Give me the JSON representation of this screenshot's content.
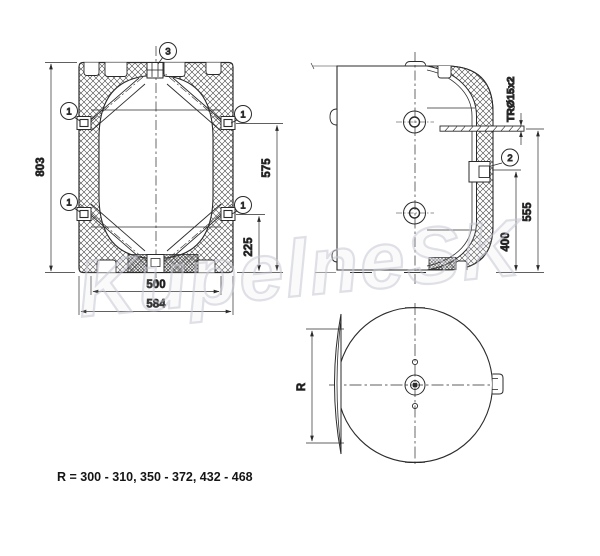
{
  "watermark": "KupelneSK",
  "note": "R = 300 - 310, 350 - 372, 432 - 468",
  "colors": {
    "line": "#2b2b2b",
    "dim_text": "#1c1c1c",
    "watermark": "#c7c9d4"
  },
  "front_view": {
    "dim_height": "803",
    "dim_upper_port": "575",
    "dim_lower_port": "225",
    "dim_inner_width": "500",
    "dim_outer_width": "584",
    "callout_top": "3",
    "callout_side": "1"
  },
  "side_view": {
    "pipe_label": "TRØ15x2",
    "dim_total_height": "555",
    "dim_fitting_height": "400",
    "callout_fitting": "2"
  },
  "bottom_view": {
    "radius_label": "R"
  }
}
